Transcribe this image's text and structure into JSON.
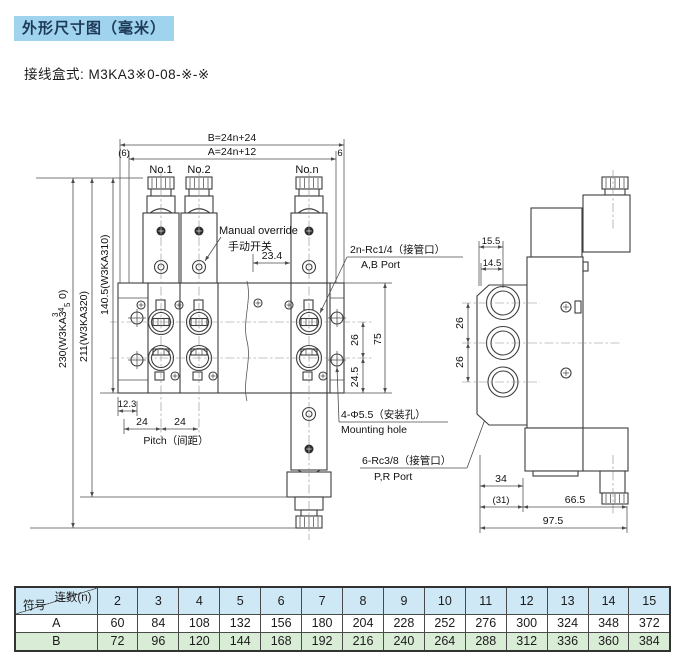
{
  "page": {
    "title": "外形尺寸图（毫米）",
    "subtitle": "接线盒式: M3KA3※0-08-※-※"
  },
  "drawing": {
    "front": {
      "dim_b": "B=24n+24",
      "dim_a": "A=24n+12",
      "end_left": "(6)",
      "end_right": "6",
      "station1": "No.1",
      "station2": "No.2",
      "station_n": "No.n",
      "manual_override_en": "Manual override",
      "manual_override_zh": "手动开关",
      "dim_23_4": "23.4",
      "port_ab_spec": "2n-Rc1/4（接管口）",
      "port_ab_name": "A,B Port",
      "height_total_prefix": "230(W3KA3",
      "height_total_d1": "3",
      "height_total_d2": "4",
      "height_total_d3": "5",
      "height_total_suffix": "0)",
      "height_211": "211(W3KA320)",
      "height_140": "140.5(W3KA310)",
      "dim_12_3": "12.3",
      "dim_24_first": "24",
      "dim_24_second": "24",
      "pitch_label": "Pitch（间距）",
      "dim_26": "26",
      "dim_24_5": "24.5",
      "dim_75": "75",
      "mounting_spec": "4-Φ5.5（安装孔）",
      "mounting_name": "Mounting hole",
      "port_pr_spec": "6-Rc3/8（接管口）",
      "port_pr_name": "P,R Port"
    },
    "side": {
      "dim_15_5": "15.5",
      "dim_14_5": "14.5",
      "dim_26_upper": "26",
      "dim_26_lower": "26",
      "dim_34": "34",
      "dim_31": "(31)",
      "dim_66_5": "66.5",
      "dim_97_5": "97.5"
    }
  },
  "table": {
    "corner_top": "连数(n)",
    "corner_bottom": "符号",
    "columns": [
      "2",
      "3",
      "4",
      "5",
      "6",
      "7",
      "8",
      "9",
      "10",
      "11",
      "12",
      "13",
      "14",
      "15"
    ],
    "rows": [
      {
        "label": "A",
        "values": [
          60,
          84,
          108,
          132,
          156,
          180,
          204,
          228,
          252,
          276,
          300,
          324,
          348,
          372
        ]
      },
      {
        "label": "B",
        "values": [
          72,
          96,
          120,
          144,
          168,
          192,
          216,
          240,
          264,
          288,
          312,
          336,
          360,
          384
        ]
      }
    ]
  },
  "colors": {
    "title_bg": "#9fd3ee",
    "table_header_bg": "#cfe8f6",
    "table_row_b_bg": "#d9edd6",
    "line": "#3d3d3d"
  }
}
